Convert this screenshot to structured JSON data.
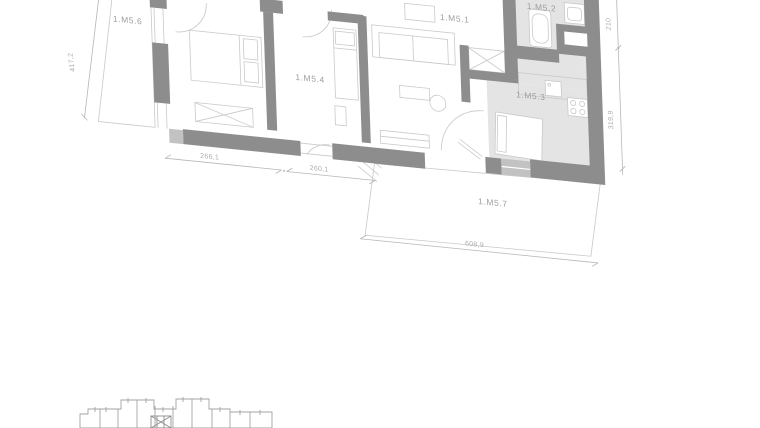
{
  "drawing": {
    "type": "apartment floor plan with bottom key plan",
    "rooms": [
      {
        "label": "1.M5.6"
      },
      {
        "label": "1.M5.4"
      },
      {
        "label": "1.M5.1"
      },
      {
        "label": "1.M5.2"
      },
      {
        "label": "1.M5.3"
      },
      {
        "label": "1.M5.7"
      }
    ],
    "dimensions": {
      "left": "417,2",
      "bottom_room1": "266,1",
      "bottom_room2": "260,1",
      "terrace": "608,9",
      "right_top": "210",
      "right_bottom": "319,9"
    },
    "colors": {
      "wall": "#8d8d8d",
      "highlight_room_fill": "#e4e4e4",
      "window_fill": "#c2c2c2",
      "thin_line": "#c9c9c9",
      "dimension_line": "#b6b6b6",
      "label_text": "#9e9e9e",
      "background": "#ffffff"
    }
  }
}
